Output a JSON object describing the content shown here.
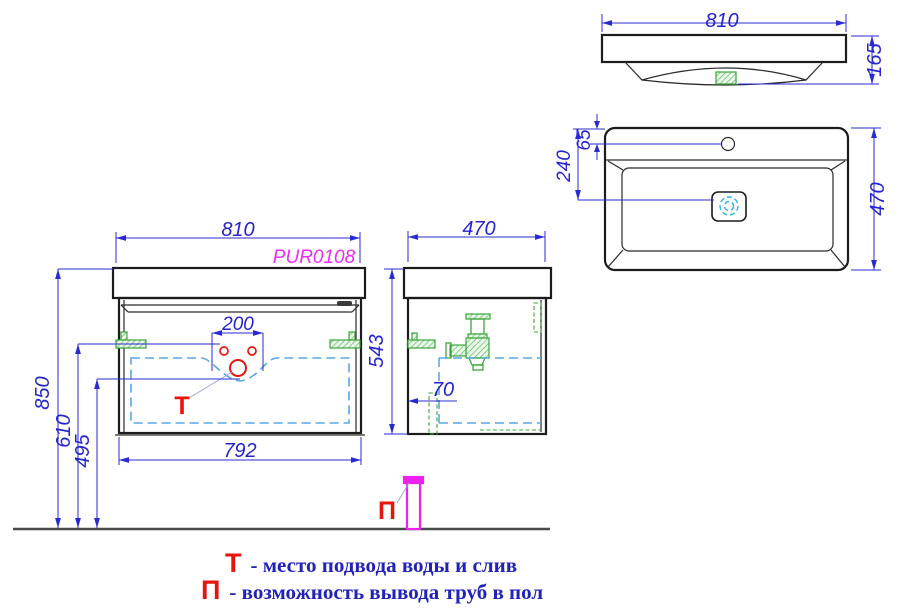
{
  "labels": {
    "product_code": "PUR0108",
    "water_marker": "Т",
    "floor_marker": "П"
  },
  "dims": {
    "front_width": "810",
    "front_bottom_width": "792",
    "height_total": "850",
    "height_supply": "610",
    "height_drain": "495",
    "cutout_width": "200",
    "side_depth": "470",
    "side_height": "543",
    "pipe_offset": "70",
    "basin_width": "810",
    "basin_height": "165",
    "basin_depth": "470",
    "faucet_offset": "65",
    "drain_offset": "240"
  },
  "legend": {
    "items": [
      {
        "symbol": "Т",
        "text": "- место подвода воды и слив"
      },
      {
        "symbol": "П",
        "text": "- возможность вывода труб в пол"
      }
    ]
  },
  "colors": {
    "dimension_blue": "#2323cf",
    "outline_black": "#1c1c1c",
    "hardware_green": "#3aa63a",
    "drawer_dash_blue": "#5aa7e8",
    "marker_red": "#e8150d",
    "product_magenta": "#f02bf0",
    "pipe_magenta": "#ee22ee",
    "legend_blue": "#2121bb"
  }
}
